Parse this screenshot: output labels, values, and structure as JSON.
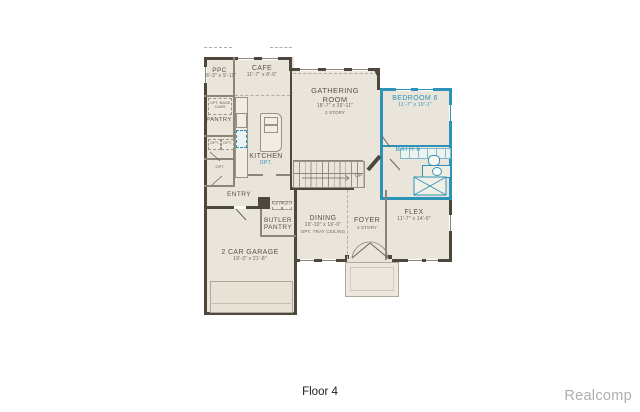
{
  "footer": {
    "floor_label": "Floor 4",
    "watermark": "Realcomp"
  },
  "palette": {
    "wall": "#4d473e",
    "room_fill": "#e9e5da",
    "highlight": "#2e93b8",
    "label_text": "#5a5248"
  },
  "rooms": {
    "ppc": {
      "name": "PPC",
      "dims": "6'-3\" x 9'-11\""
    },
    "cafe": {
      "name": "CAFE",
      "dims": "11'-7\" x 8'-6\""
    },
    "pantry": {
      "name": "PANTRY"
    },
    "kitchen": {
      "name": "KITCHEN",
      "opt": "OPT."
    },
    "gathering_room": {
      "name": "GATHERING ROOM",
      "dims": "18'-7\" x 20'-11\"",
      "note": "2 STORY"
    },
    "bedroom6": {
      "name": "BEDROOM 6",
      "dims": "11'-7\" x 10'-1\""
    },
    "bath6": {
      "name": "BATH 6"
    },
    "entry": {
      "name": "ENTRY"
    },
    "butler_pantry": {
      "name": "BUTLER PANTRY"
    },
    "dining": {
      "name": "DINING",
      "dims": "10'-10\" x 16'-0\"",
      "note": "OPT. TRAY CEILING"
    },
    "foyer": {
      "name": "FOYER",
      "note": "2 STORY"
    },
    "flex": {
      "name": "FLEX",
      "dims": "11'-7\" x 14'-0\""
    },
    "garage": {
      "name": "2 CAR GARAGE",
      "dims": "19'-3\" x 21'-8\""
    }
  },
  "annotations": {
    "opt_base_cabs": "OPT. BASE CABS",
    "up": "UP",
    "opt_closet_a": "OPT.",
    "opt_closet_b": "OPT.",
    "opt_closet_c": "OPT.",
    "opt_kitchen": "OPT.",
    "opt_butler_a": "OPT.",
    "opt_butler_b": "OPT."
  }
}
